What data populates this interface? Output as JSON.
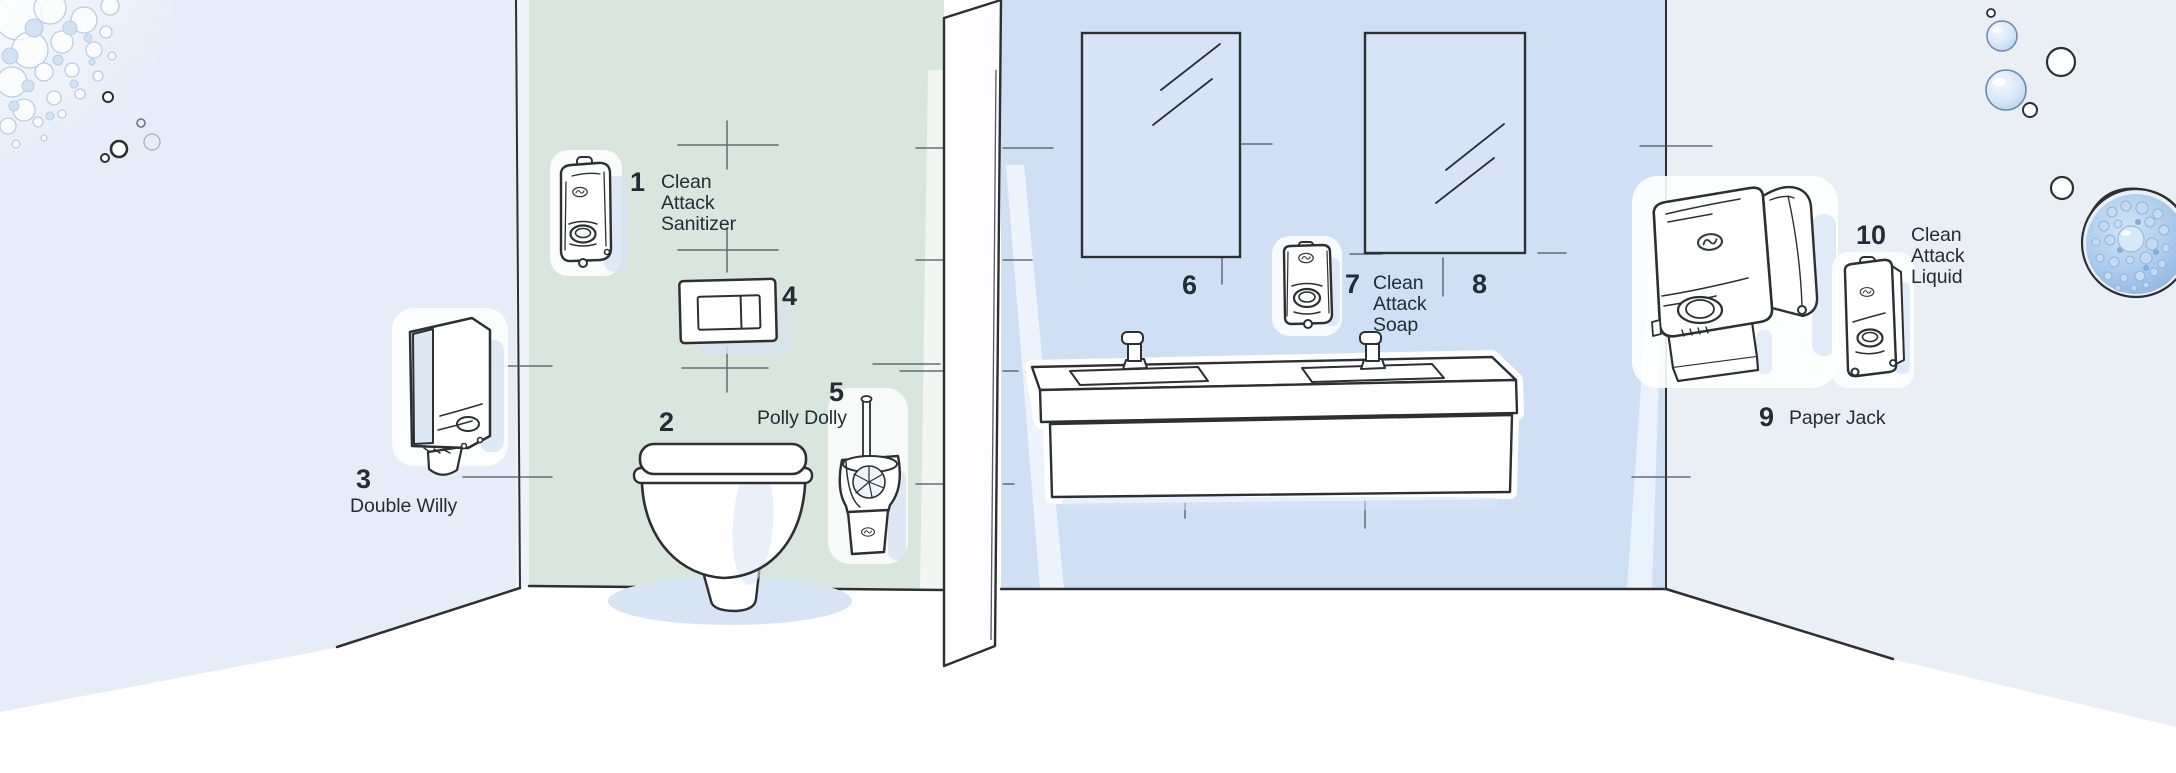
{
  "products": [
    {
      "number": "1",
      "name": "Clean Attack Sanitizer"
    },
    {
      "number": "2",
      "name": ""
    },
    {
      "number": "3",
      "name": "Double Willy"
    },
    {
      "number": "4",
      "name": ""
    },
    {
      "number": "5",
      "name": "Polly Dolly"
    },
    {
      "number": "6",
      "name": ""
    },
    {
      "number": "7",
      "name": "Clean Attack Soap"
    },
    {
      "number": "8",
      "name": ""
    },
    {
      "number": "9",
      "name": "Paper Jack"
    },
    {
      "number": "10",
      "name": "Clean Attack Liquid"
    }
  ],
  "colors": {
    "wall_left": "#e7edf8",
    "wall_green": "#d8e6dd",
    "wall_blue": "#cfe0f5",
    "wall_right": "#eaeff6",
    "mirror": "#d7e4f7",
    "soft_shadow": "#d7e4f4",
    "outline": "#2d2f33",
    "text": "#242d36",
    "floor": "#ffffff"
  }
}
